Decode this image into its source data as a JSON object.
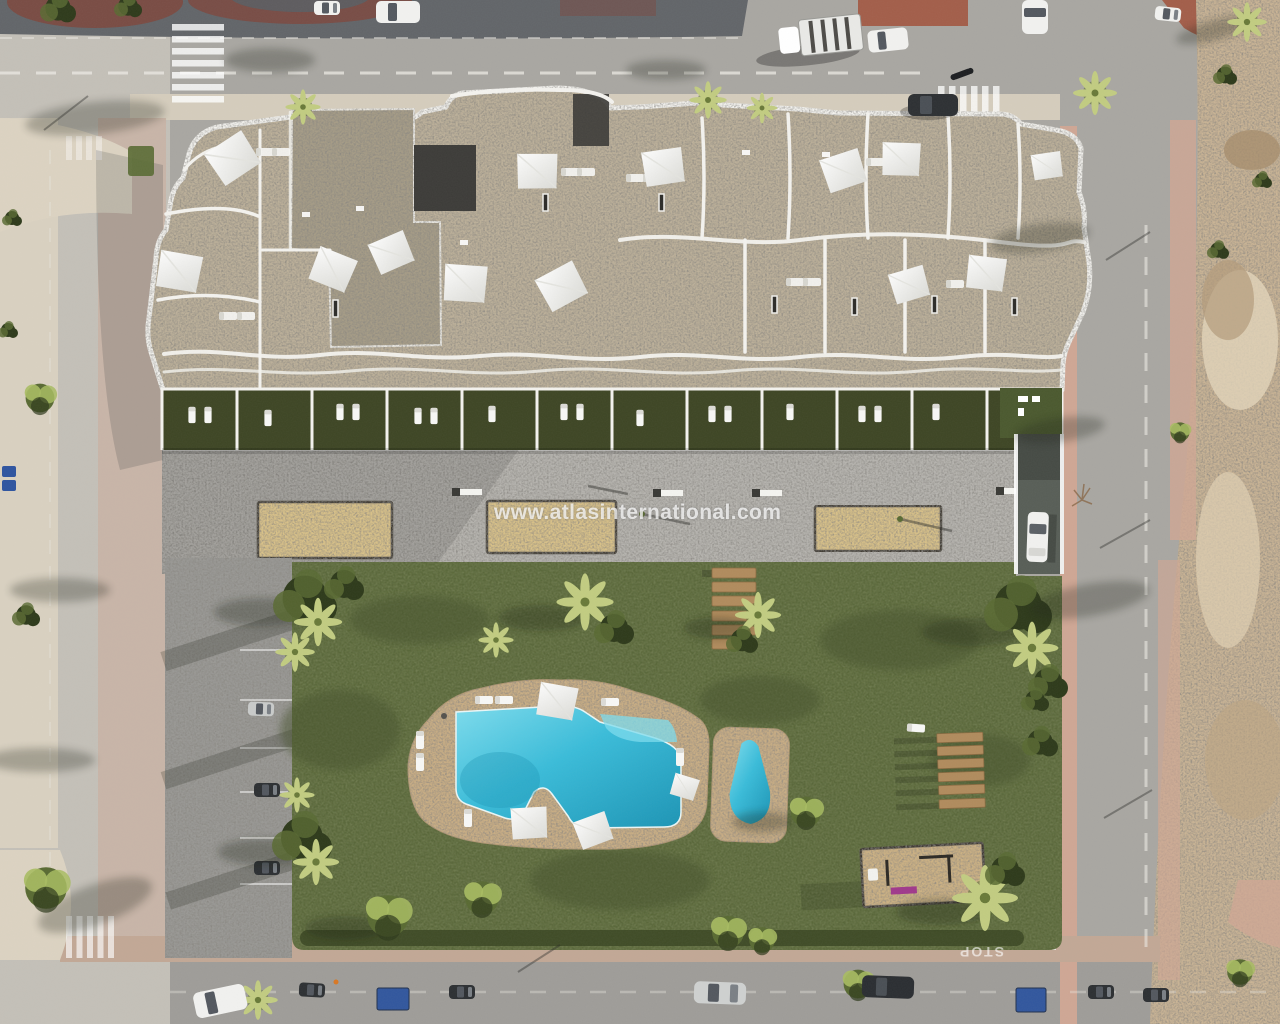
{
  "watermark": {
    "text": "www.atlasinternational.com"
  },
  "road_markings": {
    "stop_text": "STOP"
  },
  "palette": {
    "road": "#a9a7a2",
    "road-light": "#c4c0b8",
    "road-dark": "#63666a",
    "sidewalk-pink": "#cfa795",
    "sidewalk-pale": "#d5cdbd",
    "brick-red": "#a35f4b",
    "dirt": "#c9b495",
    "sand-pale": "#dcd3c2",
    "roof": "#bcb09a",
    "roof-dark": "#a69c87",
    "shaft": "#3e3d3a",
    "wall-white": "#f3f2ee",
    "terrace-lawn": "#47502c",
    "plaza": "#b6b4af",
    "sandpit": "#d8c189",
    "grass": "#5a673b",
    "grass-dark": "#46522d",
    "deck": "#c9ae85",
    "pool-light": "#7edced",
    "pool": "#3bbcd9",
    "pool-deep": "#1e95b5",
    "wood": "#b18c5e",
    "tree-dark": "#2f3b1c",
    "tree-mid": "#5a6b34",
    "tree-light": "#a8bc63",
    "palm-leaf": "#c2cc82",
    "vehicle-white": "#f1f1ef",
    "vehicle-dark": "#2e3134",
    "vehicle-silver": "#c9cbca",
    "dumpster-blue": "#33589e",
    "ramp": "#595f58"
  }
}
